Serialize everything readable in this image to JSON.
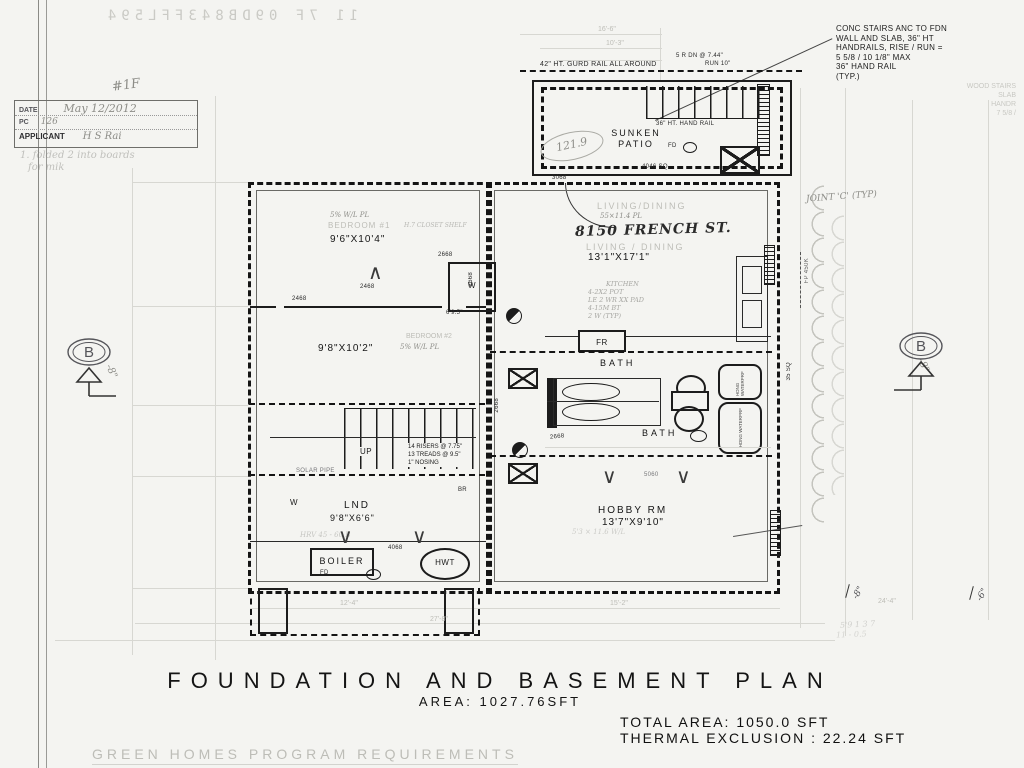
{
  "page": {
    "bleedthrough": "11 7F 09DB843FFL594",
    "title": "FOUNDATION AND BASEMENT PLAN",
    "area": "AREA:  1027.76SFT",
    "total_area": "TOTAL  AREA:  1050.0  SFT",
    "thermal": "THERMAL  EXCLUSION  : 22.24  SFT",
    "footer": "GREEN  HOMES  PROGRAM  REQUIREMENTS"
  },
  "stamp": {
    "hash": "#1F",
    "date_label": "DATE",
    "date_value": "May 12/2012",
    "pc_label": "PC",
    "pc_value": "126",
    "applicant_label": "APPLICANT",
    "applicant_value": "H S Rai",
    "note1": "1. folded 2 into boards",
    "note2": "for mik"
  },
  "note_box": {
    "l1": "CONC STAIRS ANC TO FDN",
    "l2": "WALL AND SLAB, 36\" HT",
    "l3": "HANDRAILS, RISE / RUN =",
    "l4": "5 5/8 / 10  1/8\" MAX",
    "l5": "36\" HAND RAIL",
    "l6": "(TYP.)"
  },
  "faint_corner": {
    "l1": "WOOD STAIRS",
    "l2": "SLAB",
    "l3": "HANDR",
    "l4": "7 5/8 /"
  },
  "patio": {
    "guard_rail": "42\" HT. GURD RAIL ALL AROUND",
    "risers": "5 R DN @ 7.44\"",
    "run": "RUN 10\"",
    "handrail": "36\" HT. HAND RAIL",
    "name1": "SUNKEN",
    "name2": "PATIO",
    "fd": "FD",
    "area_tag": "4046 SQ",
    "door_tag": "3068",
    "pencil_area": "121.9"
  },
  "bed1": {
    "ghost": "BEDROOM #1",
    "pencil": "5% W/L PL",
    "dim": "9'6\"X10'4\"",
    "closet_note": "H.7 CLOSET SHELF",
    "w": "W",
    "door1": "2668",
    "door2": "2468",
    "door3": "2468",
    "door4": "2668",
    "tag": "6'9.5\""
  },
  "bed2": {
    "ghost": "BEDROOM #2",
    "pencil": "5% W/L PL",
    "dim": "9'8\"X10'2\""
  },
  "stairs": {
    "up": "UP",
    "l1": "14 RISERS @ 7.75\"",
    "l2": "13 TREADS @ 9.5\"",
    "l3": "1\" NOSING",
    "solar": "SOLAR PIPE"
  },
  "lnd": {
    "name": "LND",
    "dim": "9'8\"X6'6\"",
    "w": "W",
    "br": "BR",
    "pencil": "HRV 45 - 60 B",
    "door": "4068"
  },
  "boiler": {
    "label": "BOILER",
    "hwt": "HWT",
    "fd": "FD"
  },
  "living": {
    "ghost1": "LIVING/DINING",
    "pencil1": "55×11.4 PL",
    "address": "8150 FRENCH ST.",
    "ghost2": "LIVING / DINING",
    "dim": "13'1\"X17'1\""
  },
  "kitchen": {
    "l1": "KITCHEN",
    "l2": "4-2X2 POT",
    "l3": "LE 2 WR XX PAD",
    "l4": "4-15M BT",
    "l5": "2 W (TYP)",
    "fr": "FR"
  },
  "bath": {
    "bath1": "BATH",
    "bath2": "BATH",
    "door_v": "2668",
    "door_h": "2668",
    "shower1": "HDNG WATERPRF",
    "shower2": "HDNG WATERPRF"
  },
  "hobby": {
    "name": "HOBBY RM",
    "dim": "13'7\"X9'10\"",
    "pencil": "5'3 × 11.6 W/L",
    "window": "5060"
  },
  "side": {
    "joint": "JOINT 'C' (TYP)",
    "fp": "FP 450K",
    "sq": "35 SQ",
    "b_left": "B",
    "b_right": "B",
    "m8_left": "-8\"",
    "m8_right": "-8\"",
    "m8_bot": "-8\"",
    "m6_bot": "-6\""
  },
  "dims": {
    "top1": "16'-6\"",
    "top2": "10'-3\"",
    "bot1": "12'-4\"",
    "bot2": "15'-2\"",
    "bot3": "27'-8\"",
    "bot4": "24'-4\"",
    "scribble1": "5'9 1 3 7",
    "scribble2": "11 - 0.5"
  }
}
